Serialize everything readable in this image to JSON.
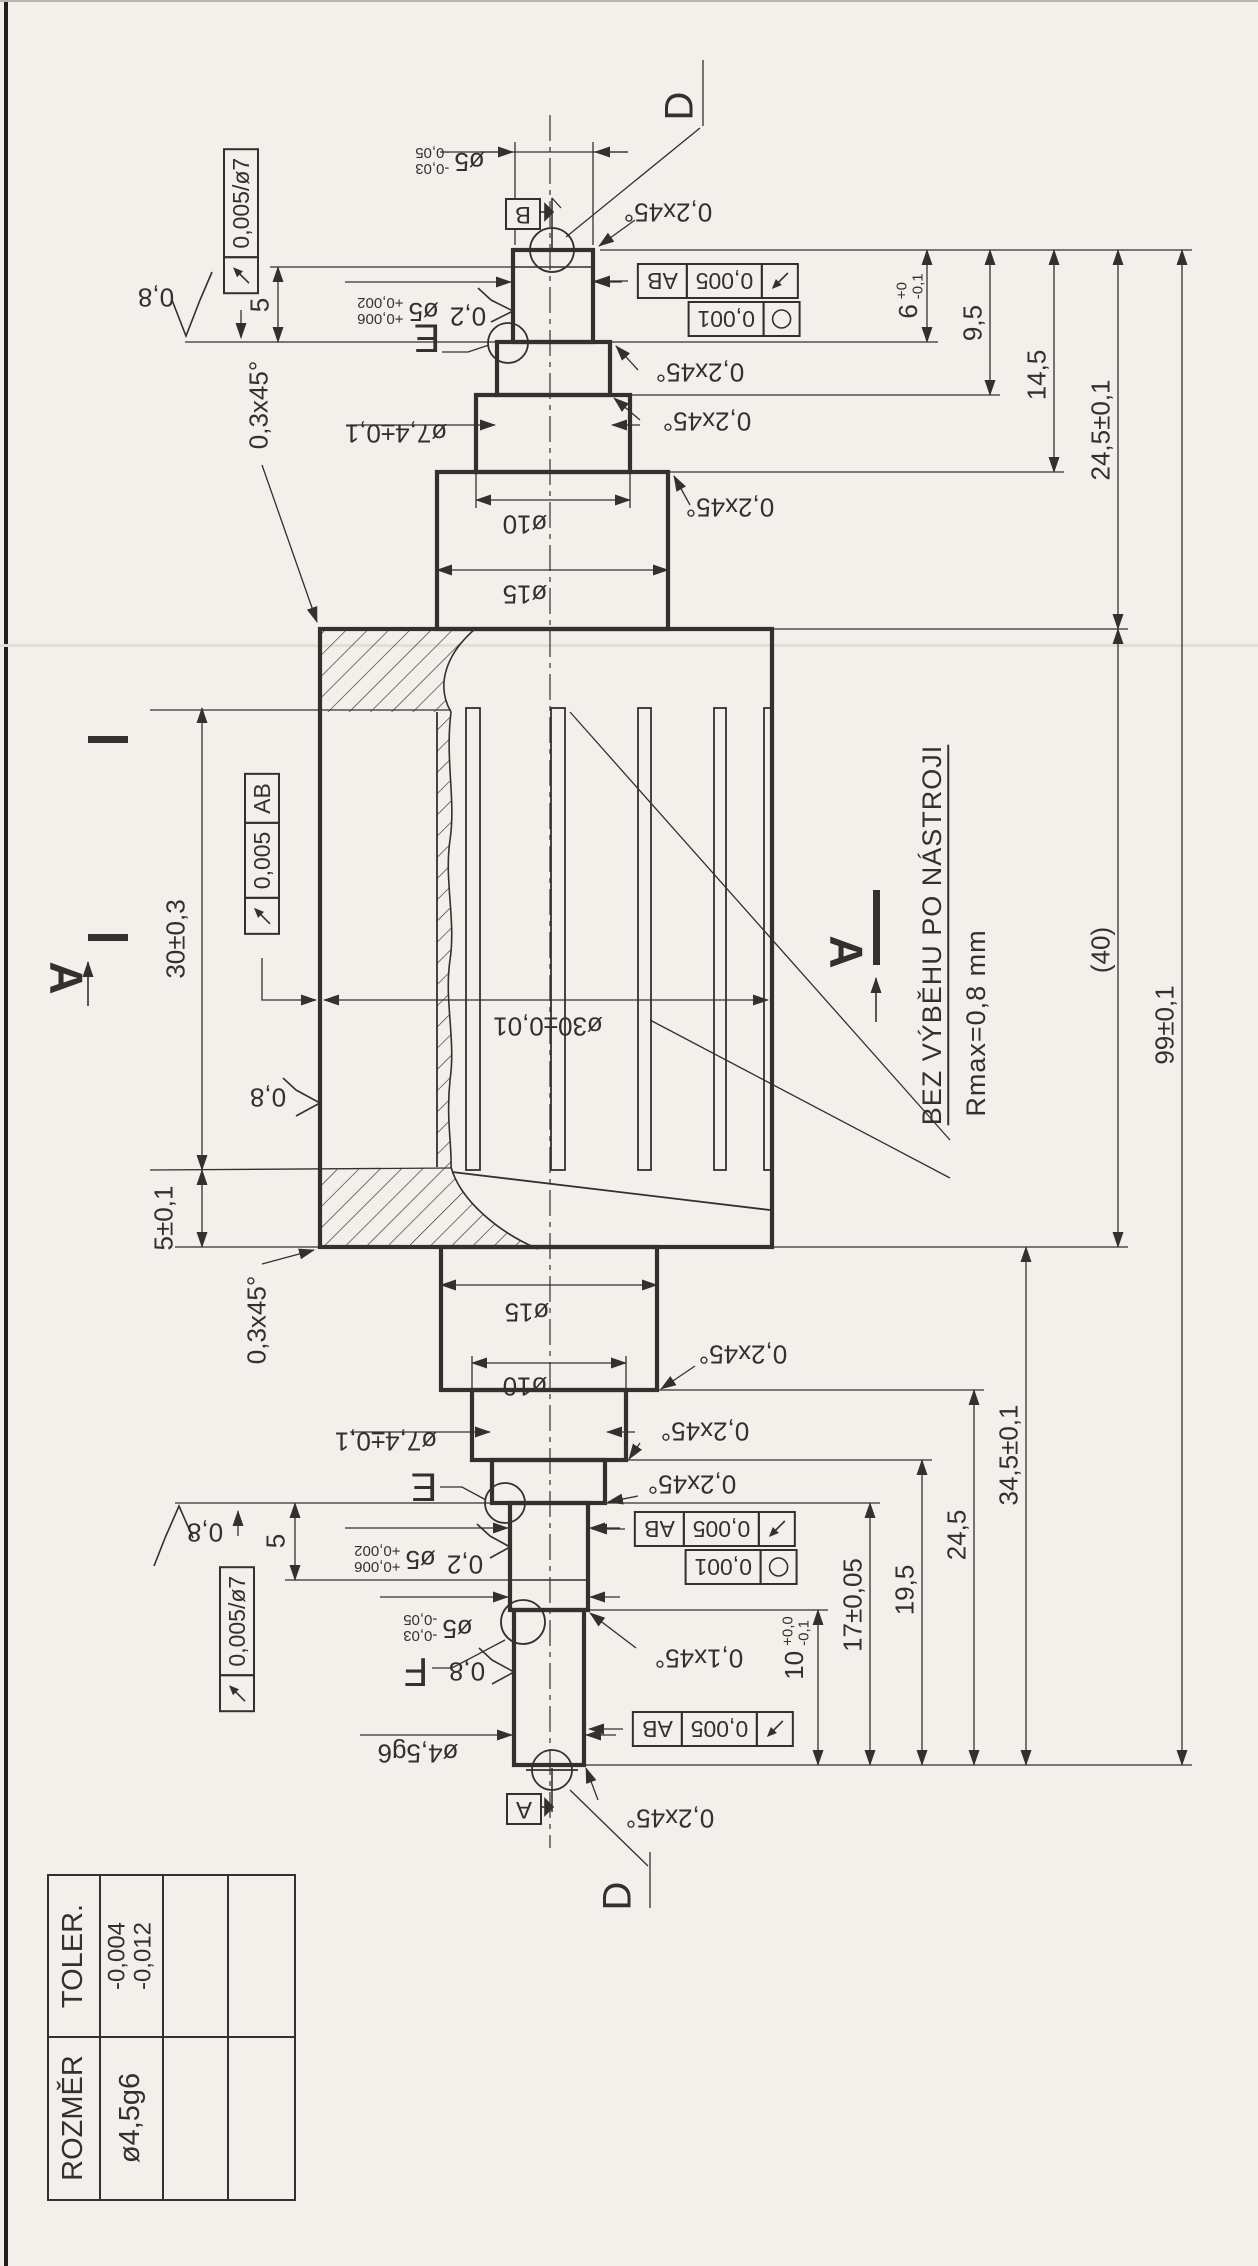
{
  "page": {
    "background": "#f2f0ea",
    "ink": "#33312d"
  },
  "title_block": {
    "col_rozmer": "ROZMĚR",
    "col_toler": "TOLER.",
    "row_dim": "ø4,5g6",
    "row_tol_upper": "-0,004",
    "row_tol_lower": "-0,012"
  },
  "notes": {
    "no_tool_runout": "BEZ VÝBĚHU PO NÁSTROJI",
    "rmax": "Rmax=0,8 mm"
  },
  "datums": {
    "a": "A",
    "b": "B"
  },
  "details": {
    "d": "D",
    "e": "E",
    "f": "F"
  },
  "section": {
    "label": "A"
  },
  "surface_finish": {
    "r08": "0,8",
    "r02": "0,2"
  },
  "tolerance_frames": {
    "runout_per_d7": "0,005/ø7",
    "runout": "0,005",
    "runout_datums": "AB",
    "circularity": "0,001"
  },
  "diameters": {
    "d5_minus": {
      "main": "ø5",
      "upper": "-0,03",
      "lower": "-0,05"
    },
    "d5_plus": {
      "main": "ø5",
      "upper": "+0,006",
      "lower": "+0,002"
    },
    "d74": "ø7,4±0,1",
    "d10": "ø10",
    "d15": "ø15",
    "d30": "ø30±0,01",
    "d45": "ø4,5g6"
  },
  "chamfers": {
    "c02": "0,2x45°",
    "c01": "0,1x45°",
    "c03": "0,3x45°"
  },
  "lengths": {
    "l5": "5",
    "l6": {
      "main": "6",
      "upper": "+0",
      "lower": "-0,1"
    },
    "l95": "9,5",
    "l145": "14,5",
    "l245_tol": "24,5±0,1",
    "l40": "(40)",
    "l99": "99±0,1",
    "l30": "30±0,3",
    "l5_tol": "5±0,1",
    "l345": "34,5±0,1",
    "l245": "24,5",
    "l195": "19,5",
    "l17": "17±0,05",
    "l10": {
      "main": "10",
      "upper": "+0,0",
      "lower": "-0,1"
    }
  }
}
